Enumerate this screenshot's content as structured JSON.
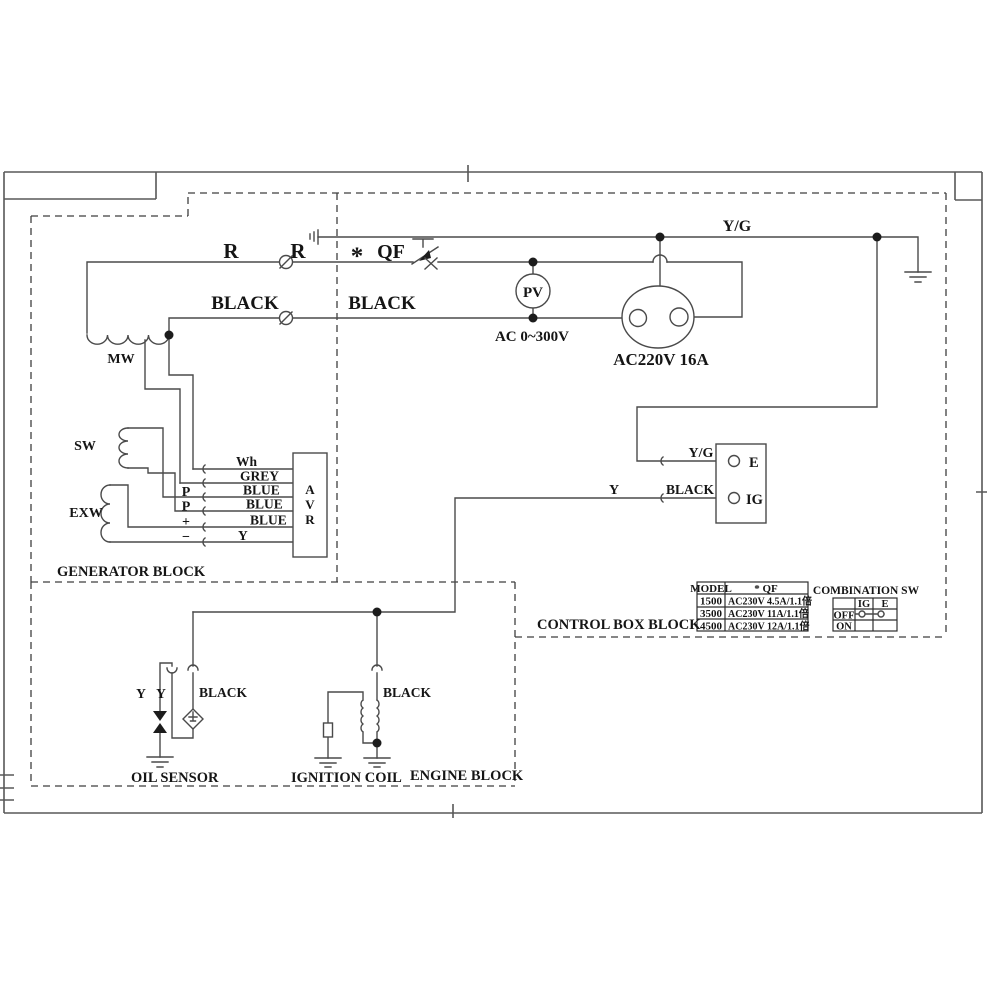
{
  "labels": {
    "r1": "R",
    "r2": "R",
    "asterisk": "*",
    "qf": "QF",
    "black_gen": "BLACK",
    "black_ctrl": "BLACK",
    "yg_top": "Y/G",
    "pv": "PV",
    "ac_range": "AC 0~300V",
    "socket": "AC220V 16A",
    "mw": "MW",
    "sw": "SW",
    "exw": "EXW",
    "avr_a": "A",
    "avr_v": "V",
    "avr_r": "R",
    "wh": "Wh",
    "grey": "GREY",
    "blue1": "BLUE",
    "blue2": "BLUE",
    "blue3": "BLUE",
    "y_avr": "Y",
    "p1": "P",
    "p2": "P",
    "plus": "+",
    "minus": "−",
    "gen_block": "GENERATOR BLOCK",
    "ctrl_block": "CONTROL BOX BLOCK",
    "engine_block": "ENGINE BLOCK",
    "yg_e": "Y/G",
    "e_term": "E",
    "black_ig": "BLACK",
    "ig_term": "IG",
    "y_mid": "Y",
    "y1": "Y",
    "y2": "Y",
    "black_oil": "BLACK",
    "black_ign": "BLACK",
    "oil_sensor": "OIL SENSOR",
    "ignition_coil": "IGNITION COIL"
  },
  "model_table": {
    "col1_header": "MODEL",
    "col2_header": "* QF",
    "rows": [
      [
        "1500",
        "AC230V 4.5A/1.1倍"
      ],
      [
        "3500",
        "AC230V 11A/1.1倍"
      ],
      [
        "4500",
        "AC230V 12A/1.1倍"
      ]
    ]
  },
  "combination_sw": {
    "title": "COMBINATION SW",
    "headers": [
      "IG",
      "E"
    ],
    "rows": [
      "OFF",
      "ON"
    ]
  }
}
